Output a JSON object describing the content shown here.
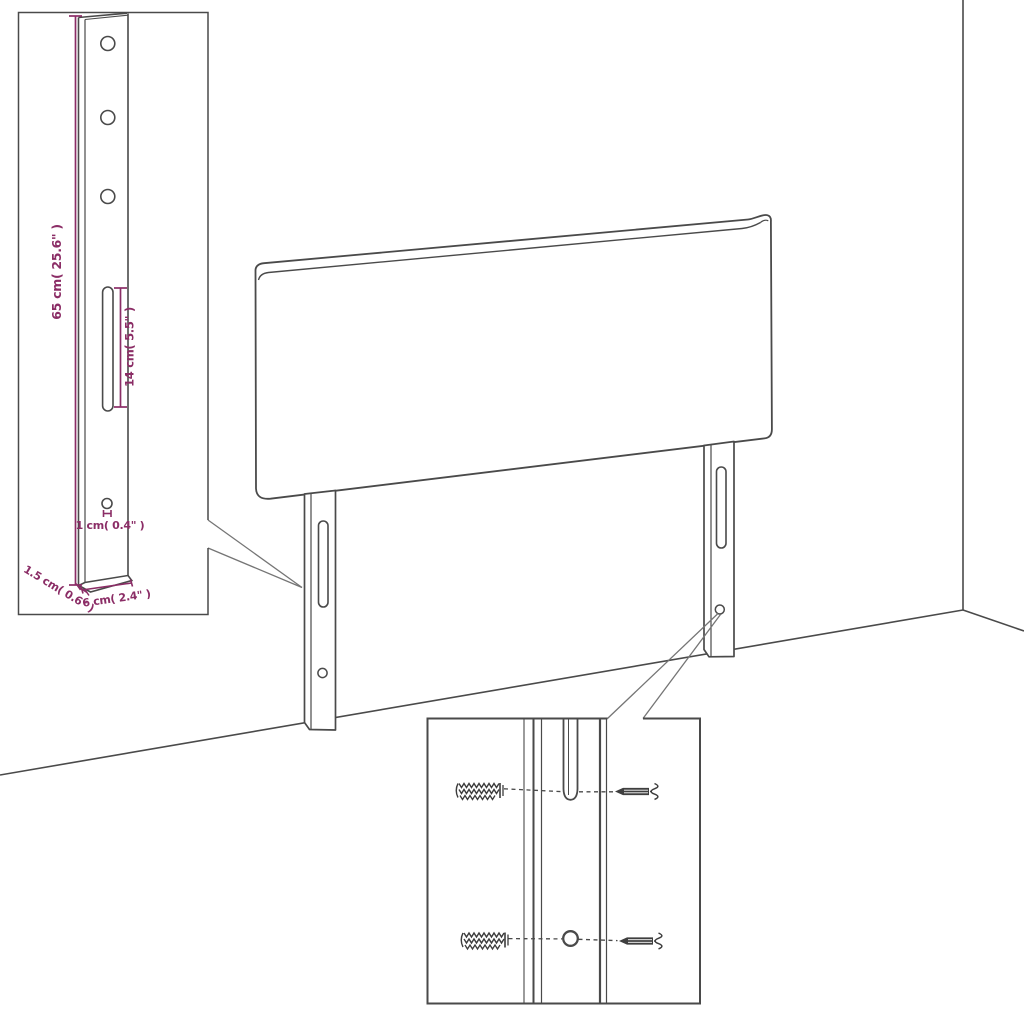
{
  "colors": {
    "line": "#4a4a4a",
    "line_soft": "#757575",
    "dimension": "#8b2d66",
    "background": "#ffffff"
  },
  "bracket_detail": {
    "height_label": "65 cm( 25.6\" )",
    "slot_label": "14 cm( 5.5\" )",
    "hole_label": "1 cm( 0.4\" )",
    "thickness_label": "1.5 cm( 0.6\" )",
    "width_label": "6 cm( 2.4\" )"
  },
  "icons": {
    "wall_plug": "wall-plug",
    "screw": "screw"
  }
}
